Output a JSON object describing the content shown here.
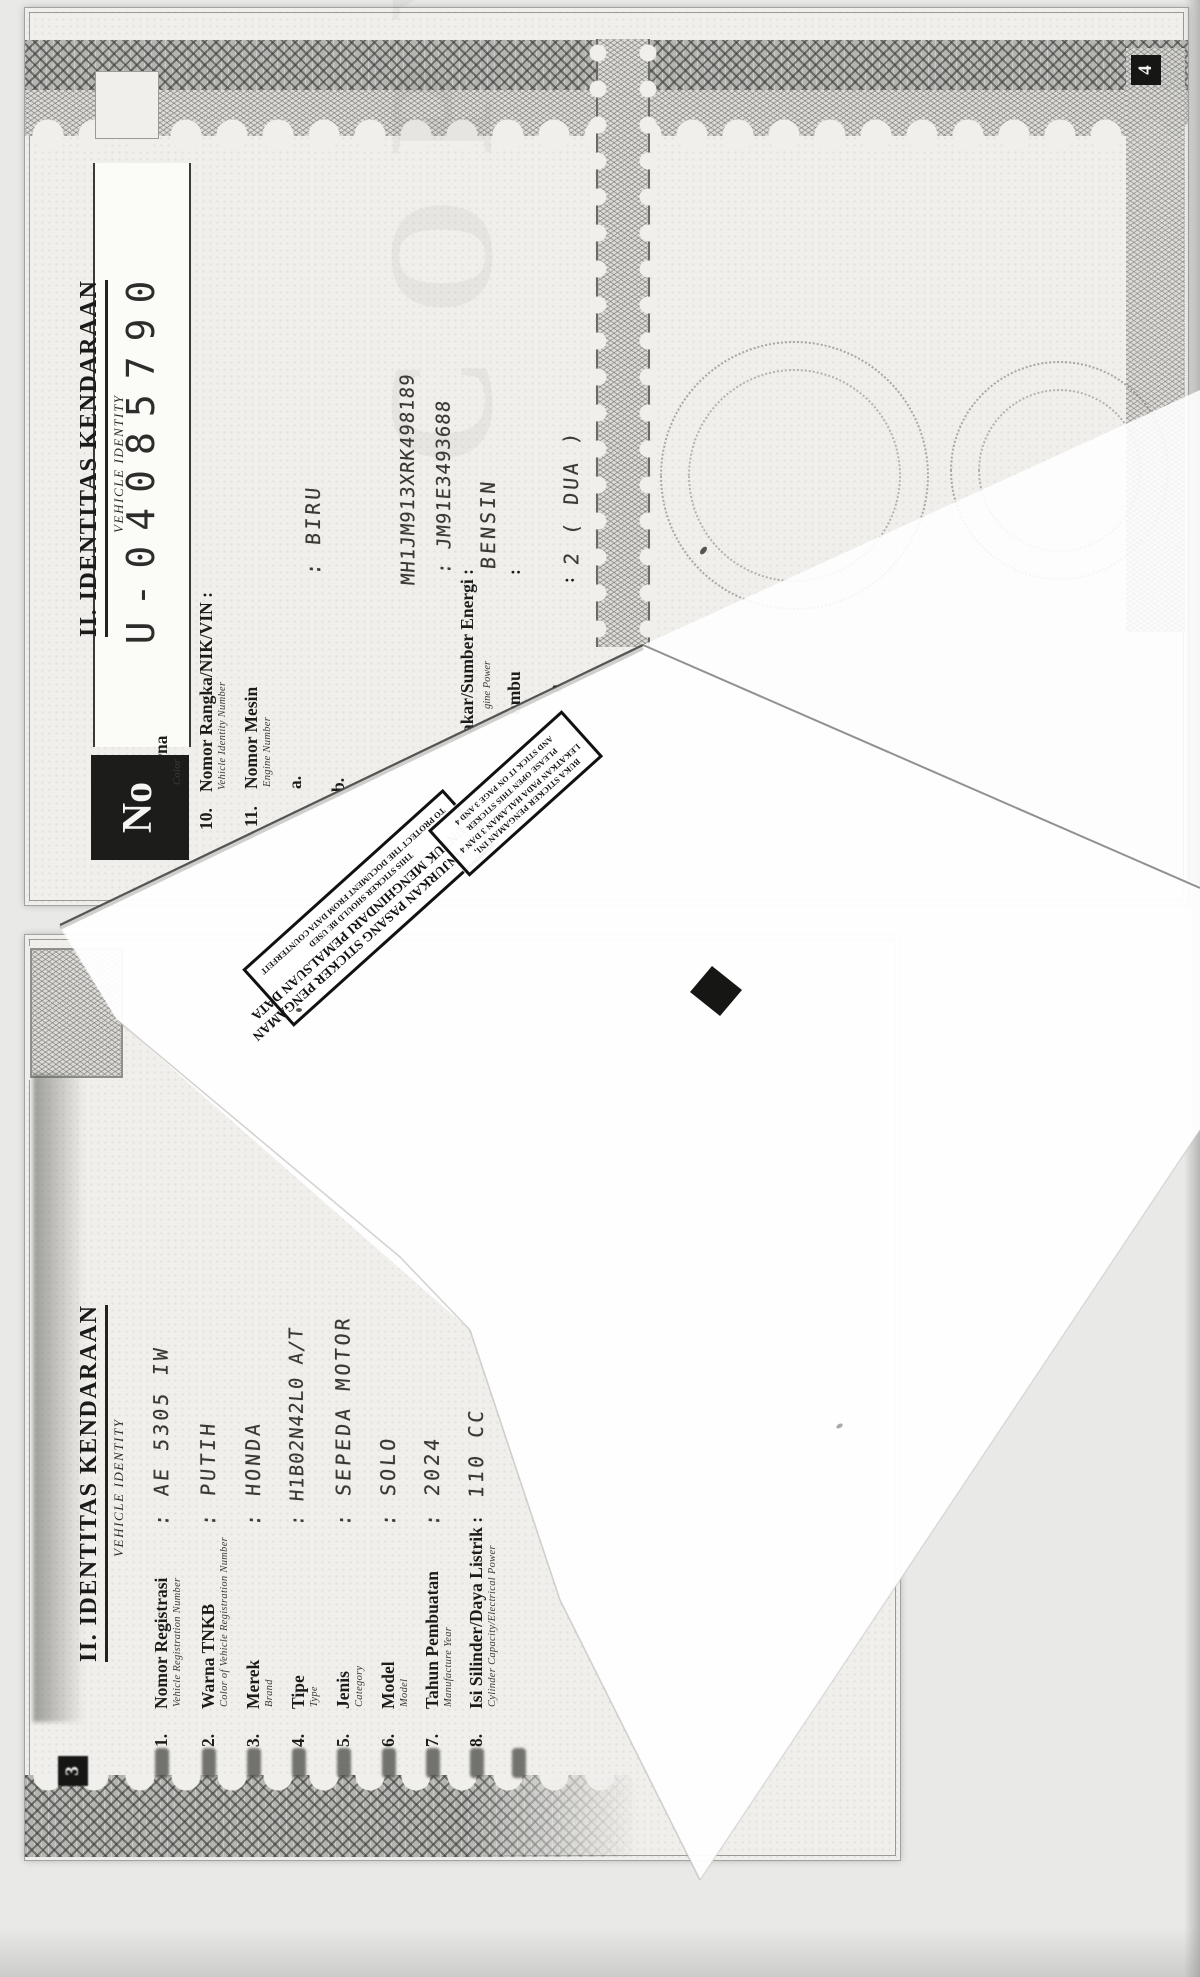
{
  "scan": {
    "watermark": "COPY"
  },
  "page4": {
    "no_label": "No",
    "serial": "U-04085790",
    "page_number": "4",
    "header": {
      "title": "II. IDENTITAS KENDARAAN",
      "subtitle": "VEHICLE IDENTITY"
    },
    "rows": [
      {
        "num": "9.",
        "label": "Warna",
        "eng": "Color"
      },
      {
        "num": "10.",
        "label": "Nomor Rangka/NIK/VIN :",
        "eng": "Vehicle Identity Number"
      },
      {
        "num": "11.",
        "label": "Nomor Mesin",
        "eng": "Engine Number"
      },
      {
        "num": "a."
      },
      {
        "num": "b."
      }
    ],
    "partial_rows": [
      {
        "label": "akar/Sumber Energi :",
        "eng": "gine Power"
      },
      {
        "label": "umbu",
        "colon": ":"
      },
      {
        "label": "a",
        "colon": ":"
      }
    ],
    "values": {
      "warna": ": BIRU",
      "rangka": "MH1JM913XRK498189",
      "mesin": ": JM91E3493688",
      "bahan_bakar": "BENSIN",
      "roda": "2 ( DUA )"
    }
  },
  "page3": {
    "page_number": "3",
    "header": {
      "title": "II. IDENTITAS KENDARAAN",
      "subtitle": "VEHICLE IDENTITY"
    },
    "rows": [
      {
        "num": "1.",
        "label": "Nomor Registrasi",
        "eng": "Vehicle Registration Number",
        "value": ": AE 5305 IW"
      },
      {
        "num": "2.",
        "label": "Warna TNKB",
        "eng": "Color of Vehicle Registration Number",
        "value": ": PUTIH"
      },
      {
        "num": "3.",
        "label": "Merek",
        "eng": "Brand",
        "value": ": HONDA"
      },
      {
        "num": "4.",
        "label": "Tipe",
        "eng": "Type",
        "value": ": H1B02N42L0 A/T"
      },
      {
        "num": "5.",
        "label": "Jenis",
        "eng": "Category",
        "value": ": SEPEDA MOTOR"
      },
      {
        "num": "6.",
        "label": "Model",
        "eng": "Model",
        "value": ": SOLO"
      },
      {
        "num": "7.",
        "label": "Tahun Pembuatan",
        "eng": "Manufacture Year",
        "value": ": 2024"
      },
      {
        "num": "8.",
        "label": "Isi Silinder/Daya Listrik :",
        "eng": "Cylinder Capacity/Electrical Power",
        "value": "110 CC"
      }
    ]
  },
  "flap": {
    "notice_small": [
      "BUKA STICKER PENGAMAN INI,",
      "LEKATKAN PADA HALAMAN 3 DAN 4",
      "PLEASE OPEN THIS STICKER",
      "AND STICK IT ON PAGE 3 AND 4"
    ],
    "notice_big_id": [
      "DIANJURKAN PASANG STICKER PENGAMAN",
      "UNTUK MENGHINDARI PEMALSUAN DATA"
    ],
    "notice_big_en": [
      "THIS STICKER SHOULD BE USED",
      "TO PROTECT THE DOCUMENT FROM DATA COUNTERFEIT"
    ]
  }
}
